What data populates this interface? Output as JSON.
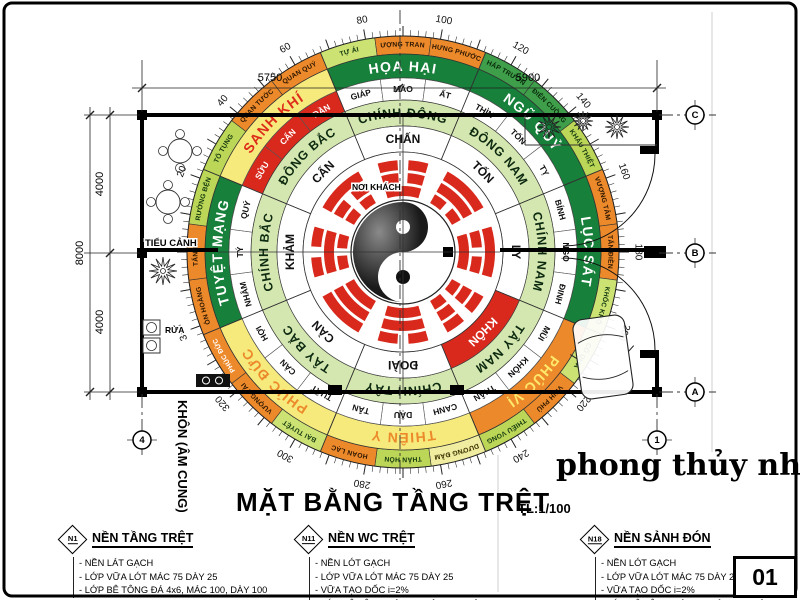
{
  "title": {
    "text": "MẶT BẰNG TẦNG TRỆT",
    "scale": "TL:1/100"
  },
  "watermark": "phong thủy nhà ở",
  "sheet_number": "01",
  "plan": {
    "labels": {
      "tieu_canh": "TIỂU CẢNH",
      "rua": "RỬA",
      "noi_khach": "NƠI KHÁCH",
      "khon_am_cung": "KHÔN (ÂM CUNG)"
    },
    "grid_markers": {
      "right": [
        "C",
        "B",
        "A"
      ],
      "bottom": [
        "4",
        "1"
      ]
    },
    "dimensions": {
      "top": [
        "5750",
        "5900"
      ],
      "left_inner": [
        "4000",
        "4000"
      ],
      "left_outer": "8000"
    }
  },
  "compass": {
    "degree_labels": [
      "20",
      "40",
      "60",
      "80",
      "100",
      "120",
      "140",
      "160",
      "180",
      "200",
      "220",
      "240",
      "260",
      "280",
      "300",
      "320",
      "340"
    ],
    "colors": {
      "highlight_red": "#d8291c",
      "dark_green": "#17803b",
      "mid_green": "#3f9e49",
      "light_green": "#bcd757",
      "pale_green": "#cce273",
      "orange": "#ec8a2b",
      "yellow": "#f6ea7d",
      "pale_yellow": "#f0eda0",
      "direction_ring_bg": "#d5e7b0"
    },
    "rings": {
      "outer24": [
        {
          "label": "TỐ TỤNG",
          "bg": "#bcd757",
          "fg": "#12380f"
        },
        {
          "label": "QUAN TƯỚC",
          "bg": "#ec8a2b",
          "fg": "#2d1600"
        },
        {
          "label": "QUAN QUÝ",
          "bg": "#ec8a2b",
          "fg": "#2d1600"
        },
        {
          "label": "TỰ ÁI",
          "bg": "#cce273",
          "fg": "#12380f"
        },
        {
          "label": "VƯỢNG TRANG",
          "bg": "#ec8a2b",
          "fg": "#2d1600"
        },
        {
          "label": "HƯNG PHƯỚC",
          "bg": "#ec8a2b",
          "fg": "#2d1600"
        },
        {
          "label": "PHÁP TRƯỜNG",
          "bg": "#3f9e49",
          "fg": "#082a0c"
        },
        {
          "label": "ĐIÊN CUỒNG",
          "bg": "#3f9e49",
          "fg": "#082a0c"
        },
        {
          "label": "KHẨU THIỆT",
          "bg": "#bcd757",
          "fg": "#12380f"
        },
        {
          "label": "VƯỢNG TÂM",
          "bg": "#ec8a2b",
          "fg": "#2d1600"
        },
        {
          "label": "TẤN ĐIỀN",
          "bg": "#ec8a2b",
          "fg": "#2d1600"
        },
        {
          "label": "KHỐC KHỔ",
          "bg": "#cce273",
          "fg": "#12380f"
        },
        {
          "label": "CÔ QUẢ",
          "bg": "#cce273",
          "fg": "#12380f"
        },
        {
          "label": "VINH PHÚ",
          "bg": "#ec8a2b",
          "fg": "#2d1600"
        },
        {
          "label": "THIẾU VONG",
          "bg": "#bcd757",
          "fg": "#12380f"
        },
        {
          "label": "DƯƠNG ĐẦM",
          "bg": "#f0eda0",
          "fg": "#3a3000"
        },
        {
          "label": "THÂN HÔN",
          "bg": "#bcd757",
          "fg": "#12380f"
        },
        {
          "label": "HOAN LẠC",
          "bg": "#ec8a2b",
          "fg": "#2d1600"
        },
        {
          "label": "BẠI TUYỆT",
          "bg": "#cce273",
          "fg": "#12380f"
        },
        {
          "label": "VƯỢNG TÀI",
          "bg": "#ec8a2b",
          "fg": "#2d1600"
        },
        {
          "label": "PHÚC ĐỨC",
          "bg": "#ec8a2b",
          "fg": "#ffffff"
        },
        {
          "label": "ÔN HOÀNG",
          "bg": "#ec8a2b",
          "fg": "#2d1600"
        },
        {
          "label": "TẤN TÀI",
          "bg": "#ec8a2b",
          "fg": "#2d1600"
        },
        {
          "label": "TRƯỜNG BỆNH",
          "bg": "#bcd757",
          "fg": "#12380f"
        }
      ],
      "main8": [
        {
          "label": "SANH KHÍ",
          "bg": "#f6ea7d",
          "fg": "#dd2d1a"
        },
        {
          "label": "HỌA HẠI",
          "bg": "#17803b",
          "fg": "#ffffff"
        },
        {
          "label": "NGŨ QUỶ",
          "bg": "#17803b",
          "fg": "#ffffff"
        },
        {
          "label": "LỤC SÁT",
          "bg": "#17803b",
          "fg": "#ffffff"
        },
        {
          "label": "PHÚC VỊ",
          "bg": "#ec8a2b",
          "fg": "#ffe96a"
        },
        {
          "label": "THIÊN Y",
          "bg": "#f6ea7d",
          "fg": "#ec8a2b"
        },
        {
          "label": "PHÚC ĐỨC",
          "bg": "#f6ea7d",
          "fg": "#ec8a2b"
        },
        {
          "label": "TUYỆT MẠNG",
          "bg": "#17803b",
          "fg": "#ffffff"
        }
      ],
      "branches": [
        {
          "label": "SỬU",
          "red": true
        },
        {
          "label": "CẤN",
          "red": true
        },
        {
          "label": "DẦN",
          "red": true
        },
        {
          "label": "GIÁP"
        },
        {
          "label": "MÃO"
        },
        {
          "label": "ẤT"
        },
        {
          "label": "THÌN"
        },
        {
          "label": "TỐN"
        },
        {
          "label": "TỴ"
        },
        {
          "label": "BÍNH"
        },
        {
          "label": "NGỌ"
        },
        {
          "label": "ĐINH"
        },
        {
          "label": "MÙI"
        },
        {
          "label": "KHÔN"
        },
        {
          "label": "THÂN"
        },
        {
          "label": "CANH"
        },
        {
          "label": "DẬU"
        },
        {
          "label": "TÂN"
        },
        {
          "label": "TUẤT"
        },
        {
          "label": "CÀN"
        },
        {
          "label": "HỢI"
        },
        {
          "label": "NHÂM"
        },
        {
          "label": "TÝ"
        },
        {
          "label": "QUÝ"
        }
      ],
      "directions": [
        "ĐÔNG BẮC",
        "CHÍNH ĐÔNG",
        "ĐÔNG NAM",
        "CHÍNH NAM",
        "TÂY NAM",
        "CHÍNH TÂY",
        "TÂY BẮC",
        "CHÍNH BẮC"
      ],
      "trigrams": [
        {
          "name": "CẤN",
          "lines": [
            0,
            0,
            1
          ]
        },
        {
          "name": "CHẤN",
          "lines": [
            1,
            0,
            0
          ]
        },
        {
          "name": "TỐN",
          "lines": [
            0,
            1,
            1
          ]
        },
        {
          "name": "LY",
          "lines": [
            1,
            0,
            1
          ]
        },
        {
          "name": "KHÔN",
          "lines": [
            0,
            0,
            0
          ],
          "red": true
        },
        {
          "name": "ĐOÀI",
          "lines": [
            1,
            1,
            0
          ]
        },
        {
          "name": "CÀN",
          "lines": [
            1,
            1,
            1
          ]
        },
        {
          "name": "KHẢM",
          "lines": [
            0,
            1,
            0
          ]
        }
      ]
    }
  },
  "notes": [
    {
      "tag": "N1",
      "title": "NỀN TẦNG TRỆT",
      "items": [
        "NỀN LÁT GẠCH",
        "LỚP VỮA LÓT MÁC 75 DÀY 25",
        "LỚP BÊ TÔNG ĐÁ 4x6, MÁC 100, DÀY 100"
      ]
    },
    {
      "tag": "N11",
      "title": "NỀN WC TRỆT",
      "items": [
        "NỀN LÓT GẠCH",
        "LỚP VỮA LÓT MÁC 75 DÀY 25",
        "VỮA TẠO DỐC i=2%",
        "LỚP BÊ TÔNG ĐÁ 4x6, MÁC 100, DÀY 100"
      ]
    },
    {
      "tag": "N18",
      "title": "NỀN SẢNH ĐÓN",
      "items": [
        "NỀN LÓT GẠCH",
        "LỚP VỮA LÓT MÁC 75 DÀY 25",
        "VỮA TẠO DỐC i=2%",
        "LỚP BÊ TÔNG ĐÁ 4x6, MÁC 100, DÀY 100"
      ]
    }
  ]
}
